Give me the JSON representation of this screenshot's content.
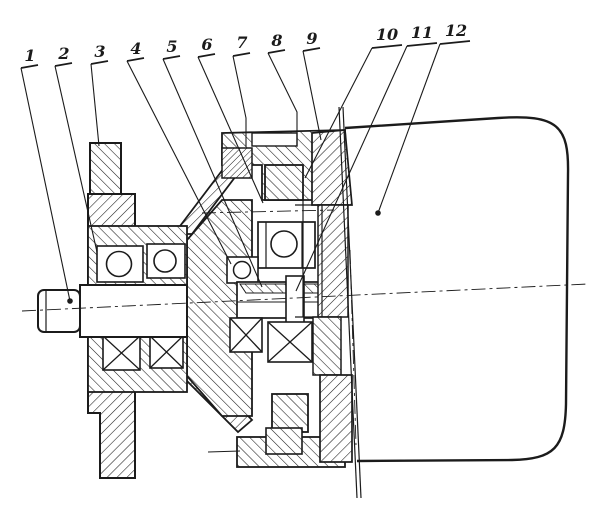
{
  "figure": {
    "kind": "sectional engineering drawing",
    "ink_color": "#1b1b1b",
    "paper_color": "#ffffff"
  },
  "part_labels": [
    {
      "text": "1",
      "num": [
        30,
        61
      ],
      "underline": [
        [
          21,
          68
        ],
        [
          38,
          65
        ]
      ],
      "leader": [
        [
          21,
          68
        ],
        [
          70,
          301
        ]
      ],
      "dot": [
        70,
        301
      ]
    },
    {
      "text": "2",
      "num": [
        64,
        59
      ],
      "underline": [
        [
          55,
          66
        ],
        [
          72,
          63
        ]
      ],
      "leader": [
        [
          55,
          66
        ],
        [
          97,
          252
        ]
      ],
      "dot": null
    },
    {
      "text": "3",
      "num": [
        100,
        57
      ],
      "underline": [
        [
          91,
          64
        ],
        [
          108,
          61
        ]
      ],
      "leader": [
        [
          91,
          64
        ],
        [
          99,
          146
        ]
      ],
      "dot": null
    },
    {
      "text": "4",
      "num": [
        136,
        54
      ],
      "underline": [
        [
          127,
          61
        ],
        [
          144,
          58
        ]
      ],
      "leader": [
        [
          127,
          61
        ],
        [
          231,
          264
        ]
      ],
      "dot": null
    },
    {
      "text": "5",
      "num": [
        172,
        52
      ],
      "underline": [
        [
          163,
          59
        ],
        [
          180,
          56
        ]
      ],
      "leader": [
        [
          163,
          59
        ],
        [
          262,
          287
        ]
      ],
      "dot": null
    },
    {
      "text": "6",
      "num": [
        207,
        50
      ],
      "underline": [
        [
          198,
          57
        ],
        [
          215,
          54
        ]
      ],
      "leader": [
        [
          198,
          57
        ],
        [
          263,
          203
        ]
      ],
      "dot": null
    },
    {
      "text": "7",
      "num": [
        242,
        48
      ],
      "underline": [
        [
          233,
          56
        ],
        [
          250,
          53
        ]
      ],
      "leader": [
        [
          233,
          56
        ],
        [
          246,
          118
        ],
        [
          246,
          147
        ]
      ],
      "dot": null
    },
    {
      "text": "8",
      "num": [
        277,
        46
      ],
      "underline": [
        [
          268,
          53
        ],
        [
          285,
          50
        ]
      ],
      "leader": [
        [
          268,
          53
        ],
        [
          297,
          112
        ],
        [
          297,
          146
        ]
      ],
      "dot": null
    },
    {
      "text": "9",
      "num": [
        312,
        44
      ],
      "underline": [
        [
          303,
          51
        ],
        [
          320,
          48
        ]
      ],
      "leader": [
        [
          303,
          51
        ],
        [
          321,
          140
        ]
      ],
      "dot": null
    },
    {
      "text": "10",
      "num": [
        387,
        40
      ],
      "underline": [
        [
          372,
          48
        ],
        [
          402,
          45
        ]
      ],
      "leader": [
        [
          372,
          48
        ],
        [
          305,
          178
        ]
      ],
      "dot": null
    },
    {
      "text": "11",
      "num": [
        422,
        38
      ],
      "underline": [
        [
          407,
          46
        ],
        [
          437,
          43
        ]
      ],
      "leader": [
        [
          407,
          46
        ],
        [
          296,
          291
        ]
      ],
      "dot": null
    },
    {
      "text": "12",
      "num": [
        456,
        36
      ],
      "underline": [
        [
          440,
          44
        ],
        [
          470,
          41
        ]
      ],
      "leader": [
        [
          440,
          44
        ],
        [
          378,
          213
        ]
      ],
      "dot": [
        378,
        213
      ]
    }
  ]
}
